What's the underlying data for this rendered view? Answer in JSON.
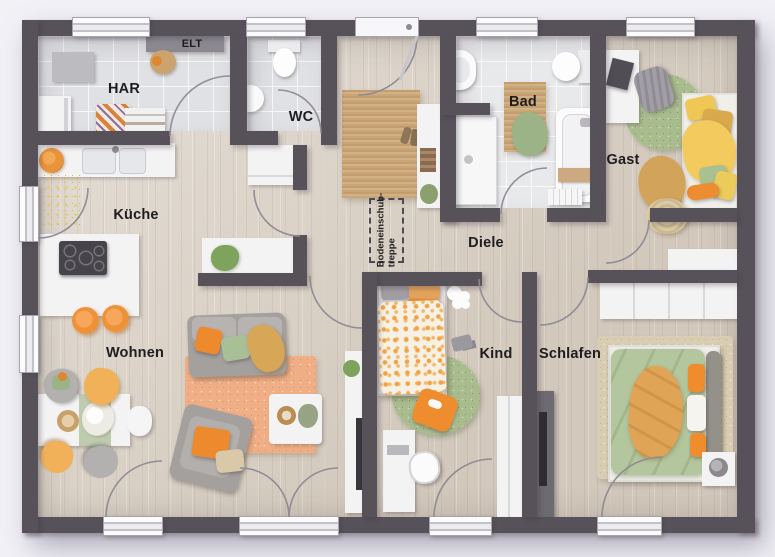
{
  "plan": {
    "type": "floor-plan",
    "rooms": [
      {
        "label": "HAR"
      },
      {
        "label": "ELT"
      },
      {
        "label": "WC"
      },
      {
        "label": "Bad"
      },
      {
        "label": "Gast"
      },
      {
        "label": "Küche"
      },
      {
        "label": "Diele"
      },
      {
        "label": "Wohnen"
      },
      {
        "label": "Kind"
      },
      {
        "label": "Schlafen"
      }
    ],
    "annotations": {
      "attic_stairs_line1": "Bodeneinschub-",
      "attic_stairs_line2": "treppe"
    },
    "palette": {
      "wall": "#57525a",
      "wood_floor": "#dcd3c7",
      "tile_floor": "#e0e1e4",
      "bath_tile": "#e8e9eb",
      "accent_orange": "#ef8c2e",
      "accent_yellow": "#f0b159",
      "accent_green": "#a9bf97",
      "jute": "#c8a678",
      "white_furniture": "#f4f3f4",
      "background": "#f2f1f6"
    }
  }
}
